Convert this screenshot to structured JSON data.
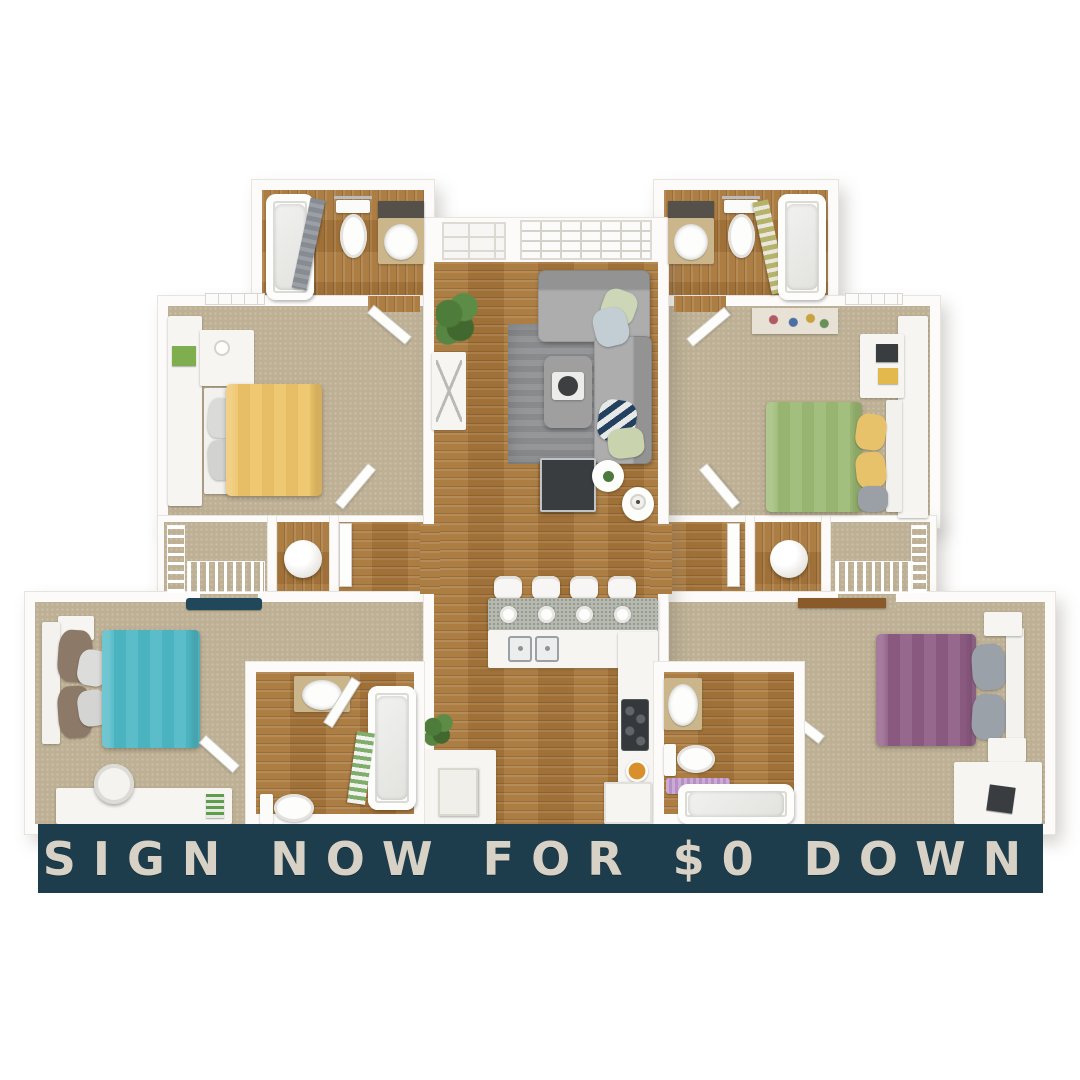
{
  "banner": {
    "label": "SIGN NOW FOR $0 DOWN",
    "background": "#1d3c4c",
    "text_color": "#d8d2c6"
  },
  "colors": {
    "wall": "#fcfbf9",
    "wood": "#a9773a",
    "carpet": "#bdb094",
    "counter": "#b7bbb2",
    "sofa": "#a3a4a3",
    "rug": "#8f9194",
    "bed_yellow": "#eec468",
    "bed_green": "#9cba74",
    "bed_teal": "#4db8c5",
    "bed_purple": "#8e5c84",
    "pillow_yellow": "#e7c26a",
    "pillow_gray": "#9ba1a8",
    "pillow_brown": "#8d7968",
    "mat_purple": "#b88fc4",
    "runner_navy": "#20485a",
    "banner_bg": "#1d3c4c",
    "banner_text": "#d8d2c6"
  },
  "floor_plan": {
    "style": "3d-top-down-apartment-floor-plan",
    "rooms": [
      {
        "id": "entry-living-room",
        "floor": "hardwood",
        "furniture": [
          "front-door",
          "window",
          "sectional-sofa",
          "area-rug",
          "ottoman-coffee-table",
          "tv-stand",
          "round-side-table",
          "lamp-table",
          "console-table",
          "floor-plant"
        ]
      },
      {
        "id": "kitchen",
        "floor": "hardwood",
        "furniture": [
          "breakfast-bar",
          "bar-stools-x4",
          "place-settings-x4",
          "double-sink",
          "stove",
          "fruit-bowl",
          "refrigerator",
          "pantry-cabinet"
        ]
      },
      {
        "id": "bedroom-upper-left",
        "floor": "carpet",
        "bed_color_key": "bed_yellow",
        "furniture": [
          "bed",
          "desk",
          "dresser"
        ]
      },
      {
        "id": "bedroom-upper-right",
        "floor": "carpet",
        "bed_color_key": "bed_green",
        "furniture": [
          "bed",
          "desk",
          "accent-rug",
          "shelf"
        ]
      },
      {
        "id": "bedroom-lower-left",
        "floor": "carpet",
        "bed_color_key": "bed_teal",
        "furniture": [
          "bed",
          "desk",
          "desk-chair",
          "nightstand",
          "runner-rug"
        ]
      },
      {
        "id": "bedroom-lower-right",
        "floor": "carpet",
        "bed_color_key": "bed_purple",
        "furniture": [
          "bed",
          "desk",
          "nightstands",
          "wood-shelf"
        ]
      },
      {
        "id": "bathroom-upper-left",
        "floor": "hardwood",
        "fixtures": [
          "bathtub",
          "shower-curtain",
          "toilet",
          "vanity-sink",
          "mirror"
        ]
      },
      {
        "id": "bathroom-upper-right",
        "floor": "hardwood",
        "fixtures": [
          "vanity-sink",
          "mirror",
          "toilet",
          "bathtub",
          "shower-curtain"
        ]
      },
      {
        "id": "bathroom-lower-left",
        "floor": "hardwood",
        "fixtures": [
          "vanity-sink",
          "toilet",
          "bathtub",
          "shower-curtain",
          "door"
        ]
      },
      {
        "id": "bathroom-lower-right",
        "floor": "hardwood",
        "fixtures": [
          "vanity-sink",
          "toilet",
          "bath-mat",
          "bathtub",
          "door"
        ]
      },
      {
        "id": "closet-left",
        "floor": "carpet",
        "fixtures": [
          "wire-shelving"
        ]
      },
      {
        "id": "closet-right",
        "floor": "carpet",
        "fixtures": [
          "wire-shelving"
        ]
      },
      {
        "id": "utility-left",
        "fixtures": [
          "water-heater"
        ]
      },
      {
        "id": "utility-right",
        "fixtures": [
          "water-heater"
        ]
      }
    ]
  }
}
